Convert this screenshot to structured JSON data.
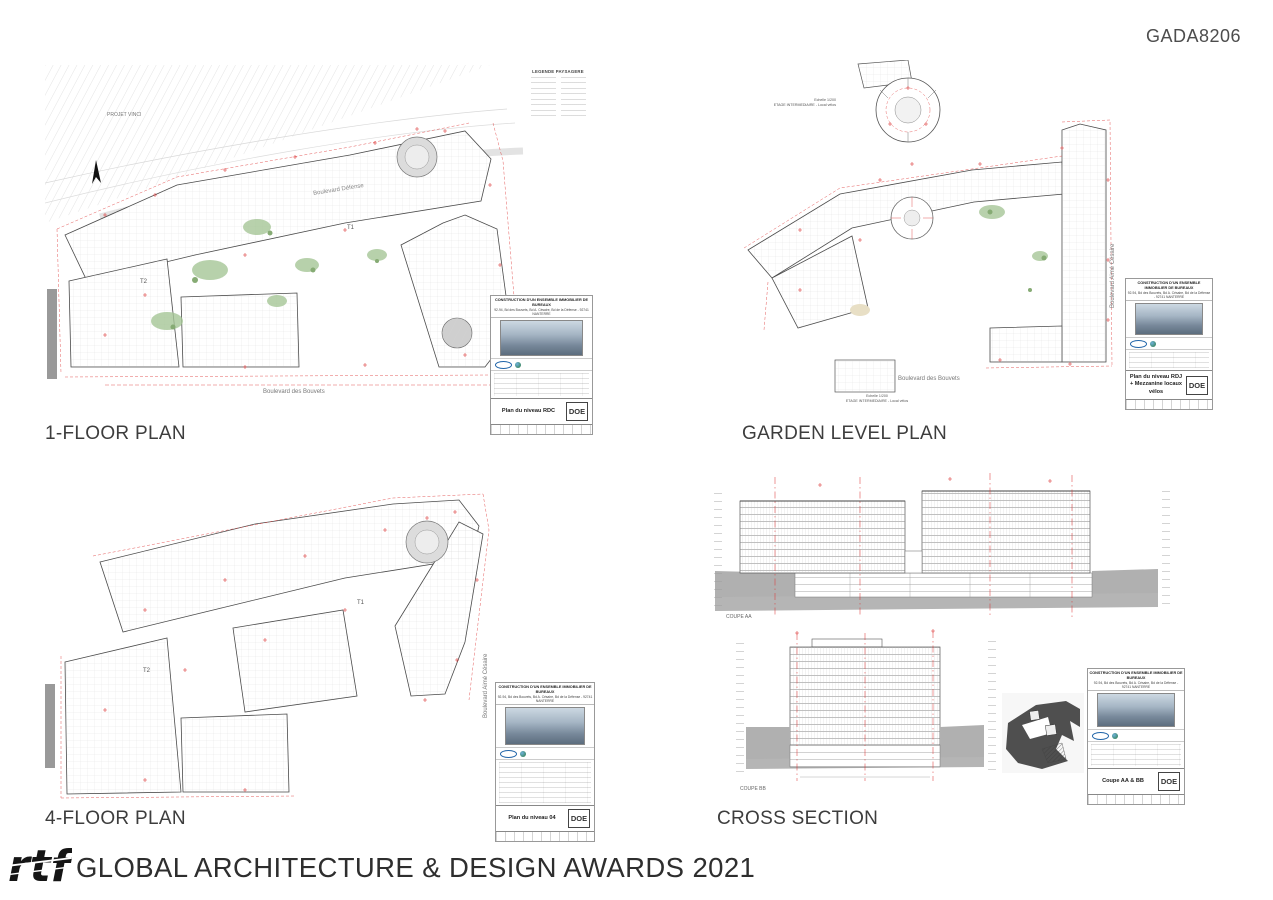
{
  "header": {
    "code": "GADA8206"
  },
  "titleblock_header": {
    "line1": "CONSTRUCTION D'UN ENSEMBLE IMMOBILIER DE BUREAUX",
    "line2": "92-94, Bd des Bouvets, Bd A. Césaire, Bd de la Défense - 92741 NANTERRE"
  },
  "panels": {
    "floor1": {
      "caption": "1-FLOOR PLAN",
      "labels": {
        "project_area": "PROJET VINCI",
        "legend_title": "LEGENDE PAYSAGERE",
        "street_top": "Boulevard Défense",
        "street_bottom": "Boulevard des Bouvets",
        "tower1": "T1",
        "tower2": "T2"
      },
      "titleblock": {
        "drawing_title": "Plan du niveau RDC",
        "stamp": "DOE"
      }
    },
    "garden": {
      "caption": "GARDEN LEVEL PLAN",
      "labels": {
        "detail_scale_top": "Echelle 1/200",
        "detail_caption_top": "ETAGE INTERMEDIAIRE - Local vélos",
        "detail_scale_bottom": "Echelle 1/200",
        "detail_caption_bottom": "ETAGE INTERMEDIAIRE - Local vélos",
        "street_right": "Boulevard Aimé Césaire",
        "street_bottom": "Boulevard des Bouvets"
      },
      "titleblock": {
        "drawing_title": "Plan du niveau RDJ + Mezzanine locaux vélos",
        "stamp": "DOE"
      }
    },
    "floor4": {
      "caption": "4-FLOOR PLAN",
      "labels": {
        "street_right": "Boulevard Aimé Césaire",
        "tower1": "T1",
        "tower2": "T2"
      },
      "titleblock": {
        "drawing_title": "Plan du niveau 04",
        "stamp": "DOE"
      }
    },
    "section": {
      "caption": "CROSS SECTION",
      "labels": {
        "coupe_aa": "COUPE AA",
        "coupe_bb": "COUPE BB"
      },
      "titleblock": {
        "drawing_title": "Coupe AA & BB",
        "stamp": "DOE"
      }
    }
  },
  "footer": {
    "logo": "rtf",
    "award_text": "GLOBAL ARCHITECTURE & DESIGN AWARDS 2021"
  }
}
